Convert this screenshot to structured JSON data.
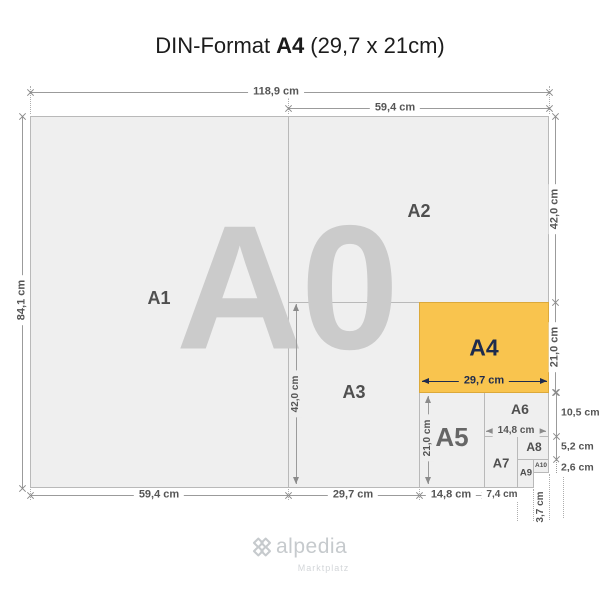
{
  "title": {
    "prefix": "DIN-Format",
    "highlight": "A4",
    "suffix": "(29,7 x 21cm)"
  },
  "watermark": "A0",
  "papers": {
    "a1": {
      "label": "A1"
    },
    "a2": {
      "label": "A2"
    },
    "a3": {
      "label": "A3"
    },
    "a4": {
      "label": "A4"
    },
    "a5": {
      "label": "A5"
    },
    "a6": {
      "label": "A6"
    },
    "a7": {
      "label": "A7"
    },
    "a8": {
      "label": "A8"
    },
    "a9": {
      "label": "A9"
    },
    "a10": {
      "label": "A10"
    }
  },
  "dimensions": {
    "a0_width": "118,9 cm",
    "a0_height": "84,1 cm",
    "a2_width": "59,4 cm",
    "a2_height": "42,0 cm",
    "a4_width": "29,7 cm",
    "a4_height": "21,0 cm",
    "a6_height": "10,5 cm",
    "a8_height": "5,2 cm",
    "a10_height": "2,6 cm",
    "a3_height": "42,0 cm",
    "a5_height": "21,0 cm",
    "a6_width": "14,8 cm",
    "a1_width": "59,4 cm",
    "a3_width": "29,7 cm",
    "a5_width": "14,8 cm",
    "a7_width": "7,4 cm",
    "a10_width": "3,7 cm"
  },
  "logo": {
    "icon": "clover-icon",
    "name": "alpedia",
    "tagline": "Marktplatz"
  },
  "colors": {
    "highlight": "#F9C44E",
    "highlight_text": "#1E2B4D",
    "paper": "#EFEFEF",
    "watermark": "#CBCBCB"
  }
}
